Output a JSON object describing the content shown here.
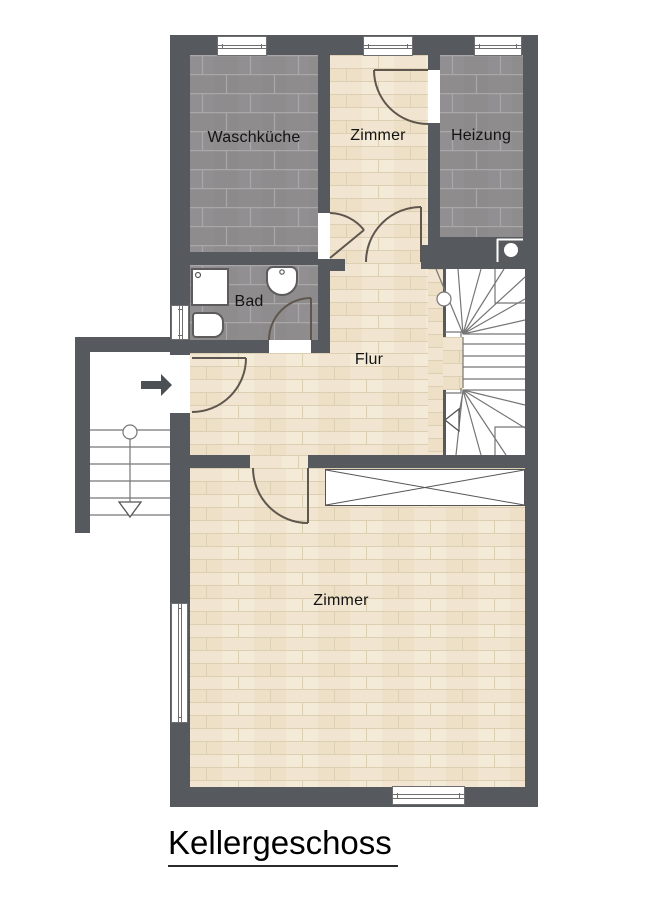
{
  "title": {
    "text": "Kellergeschoss"
  },
  "rooms": [
    {
      "id": "waschkueche",
      "label": "Waschküche"
    },
    {
      "id": "zimmer_top",
      "label": "Zimmer"
    },
    {
      "id": "heizung",
      "label": "Heizung"
    },
    {
      "id": "bad",
      "label": "Bad"
    },
    {
      "id": "flur",
      "label": "Flur"
    },
    {
      "id": "zimmer_bottom",
      "label": "Zimmer"
    }
  ],
  "colors": {
    "wall": "#565a5e",
    "tile_dark": "#8e8c8d",
    "tile_grout": "#a9a7a8",
    "wood": "#f1e5d1",
    "wood_line": "#dccfb2",
    "door_line": "#5f574d",
    "stair_line": "#767676",
    "entry_arrow": "#4b5055"
  },
  "icons": {
    "entry_arrow": "entry-direction-arrow",
    "stair_down_arrow": "stair-direction-arrow"
  }
}
